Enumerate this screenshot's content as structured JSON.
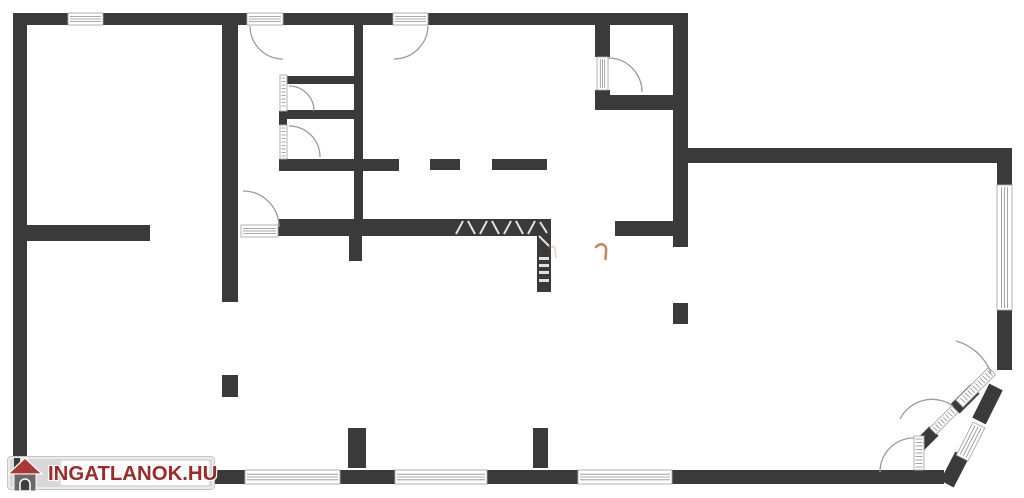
{
  "logo": {
    "text": "INGATLANOK.HU"
  },
  "colors": {
    "wall": "#3a3a3a",
    "background": "#ffffff",
    "arc": "#9b9b9b",
    "leaf_border": "#a8a8a8",
    "leaf_line": "#8f8f8f",
    "hatch": "#f4f4f4",
    "watermark_orange": "#c8805f",
    "logo_box": "#d8d8d8",
    "logo_text": "#9b2b28",
    "logo_roof": "#a83a33",
    "logo_house_body": "#696969"
  },
  "floorplan": {
    "canvas": {
      "width": 1024,
      "height": 498
    },
    "walls": [
      [
        13,
        13,
        675,
        12
      ],
      [
        13,
        13,
        14,
        461
      ],
      [
        222,
        25,
        16,
        277
      ],
      [
        354,
        25,
        9,
        211
      ],
      [
        349,
        236,
        13,
        25
      ],
      [
        279,
        159,
        120,
        12
      ],
      [
        430,
        159,
        30,
        11
      ],
      [
        492,
        159,
        55,
        11
      ],
      [
        287,
        76,
        75,
        8
      ],
      [
        287,
        110,
        75,
        9
      ],
      [
        279,
        111,
        8,
        14
      ],
      [
        595,
        25,
        15,
        32
      ],
      [
        595,
        90,
        15,
        20
      ],
      [
        610,
        95,
        63,
        15
      ],
      [
        673,
        13,
        15,
        234
      ],
      [
        688,
        148,
        324,
        15
      ],
      [
        997,
        163,
        15,
        22
      ],
      [
        997,
        310,
        15,
        60
      ],
      [
        615,
        221,
        58,
        15
      ],
      [
        278,
        219,
        273,
        17
      ],
      [
        537,
        219,
        14,
        73
      ],
      [
        27,
        225,
        123,
        16
      ],
      [
        673,
        303,
        15,
        21
      ],
      [
        222,
        375,
        16,
        22
      ],
      [
        348,
        428,
        18,
        40
      ],
      [
        533,
        428,
        15,
        40
      ],
      [
        27,
        470,
        218,
        14
      ],
      [
        340,
        470,
        55,
        14
      ],
      [
        487,
        470,
        91,
        14
      ],
      [
        672,
        470,
        272,
        14
      ]
    ],
    "windows": [
      [
        68,
        13,
        35,
        12,
        "h"
      ],
      [
        997,
        185,
        15,
        125,
        "v"
      ],
      [
        245,
        470,
        95,
        14,
        "h"
      ],
      [
        395,
        470,
        92,
        14,
        "h"
      ],
      [
        578,
        470,
        94,
        14,
        "h"
      ]
    ],
    "door_leaves": [
      [
        247,
        13,
        36,
        12,
        "h"
      ],
      [
        393,
        13,
        35,
        12,
        "h"
      ],
      [
        241,
        225,
        37,
        12,
        "h"
      ],
      [
        597,
        57,
        11,
        33,
        "v"
      ],
      [
        280,
        75,
        7,
        36,
        "r"
      ],
      [
        280,
        125,
        7,
        34,
        "r"
      ],
      [
        914,
        436,
        10,
        34,
        "r"
      ]
    ],
    "rotated_elements": [
      {
        "x": 992,
        "y": 371,
        "angle": 135,
        "len": 46,
        "th": 10,
        "kind": "leaf"
      },
      {
        "x": 933,
        "y": 431,
        "angle": -45,
        "len": 31,
        "th": 9,
        "kind": "leaf"
      },
      {
        "x": 979,
        "y": 425,
        "angle": 117,
        "len": 37,
        "th": 13,
        "kind": "window"
      }
    ],
    "diagonal_walls": [
      {
        "x1": 996,
        "y1": 387,
        "x2": 979,
        "y2": 421,
        "w": 15
      },
      {
        "x1": 962,
        "y1": 455,
        "x2": 947,
        "y2": 484,
        "w": 15
      },
      {
        "x1": 919,
        "y1": 446,
        "x2": 934,
        "y2": 431,
        "w": 13
      },
      {
        "x1": 955,
        "y1": 409,
        "x2": 975,
        "y2": 389,
        "w": 13
      }
    ],
    "door_arcs": [
      "M 250 26 A 33 33 0 0 0 283 59",
      "M 428 26 A 34 34 0 0 1 394 59",
      "M 243 191 A 36 36 0 0 1 279 227",
      "M 608 58 A 34 34 0 0 1 642 92",
      "M 289 86 A 25 25 0 0 1 314 111",
      "M 289 126 A 31 31 0 0 1 320 157",
      "M 914 438 A 34 34 0 0 0 880 472",
      "M 953 406 A 36 36 0 0 0 900 419",
      "M 956 341 A 52 52 0 0 1 991 373"
    ],
    "hatch_lines": [
      [
        463,
        221,
        456,
        234
      ],
      [
        468,
        221,
        475,
        234
      ],
      [
        487,
        221,
        480,
        234
      ],
      [
        492,
        221,
        499,
        234
      ],
      [
        511,
        221,
        504,
        234
      ],
      [
        516,
        221,
        523,
        234
      ],
      [
        535,
        221,
        528,
        234
      ],
      [
        540,
        222,
        547,
        233
      ],
      [
        539,
        236,
        549,
        246
      ]
    ],
    "hatch_dashes": [
      [
        539,
        257,
        10,
        3
      ],
      [
        539,
        264,
        10,
        3
      ],
      [
        539,
        271,
        10,
        3
      ],
      [
        539,
        279,
        10,
        3
      ]
    ],
    "watermark_marks": [
      {
        "d": "M 596 247 q 5 -5 9 -1 q 1.5 1.5 1 6 l -0.5 7",
        "w": 2.6,
        "o": 0.95
      },
      {
        "d": "M 549 248 q 4 -3 6 0 l 1 9",
        "w": 2.2,
        "o": 0.3
      }
    ]
  }
}
